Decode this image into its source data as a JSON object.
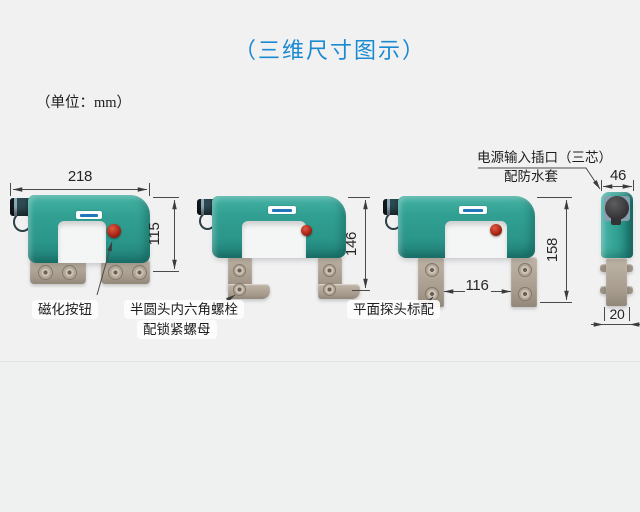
{
  "header": {
    "title": "（三维尺寸图示）",
    "unit_note": "（单位：mm）"
  },
  "dimensions": {
    "total_width": "218",
    "body_height": "115",
    "height_articulated": "146",
    "height_flat": "158",
    "pole_gap": "116",
    "side_width": "46",
    "pole_thickness": "20"
  },
  "annotations": {
    "magnetize_button": "磁化按钮",
    "hex_bolt_line1": "半圆头内六角螺栓",
    "hex_bolt_line2": "配锁紧螺母",
    "flat_probe": "平面探头标配",
    "power_socket_line1": "电源输入插口（三芯）",
    "power_socket_line2": "配防水套"
  },
  "colors": {
    "title_blue": "#1a8ad2",
    "device_teal": "#2f9e91",
    "foot_tan": "#aca092",
    "button_red": "#a92717",
    "line_gray": "#454545",
    "background": "#f1f1f2"
  }
}
